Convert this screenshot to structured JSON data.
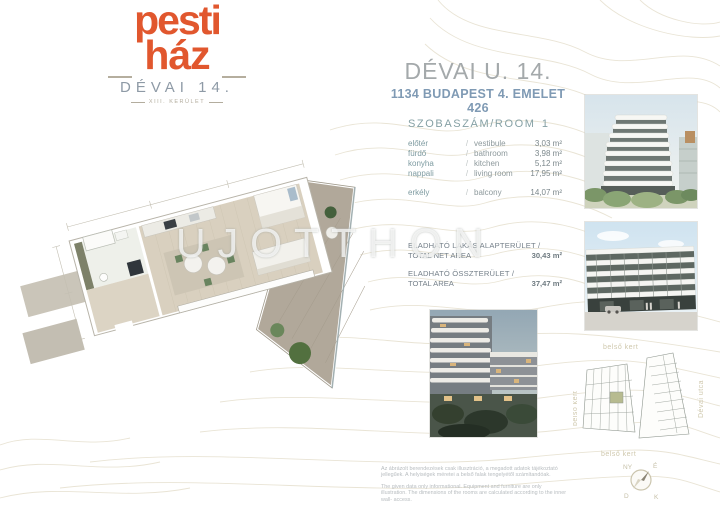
{
  "logo": {
    "word1": "pesti",
    "word2": "ház",
    "project": "DÉVAI 14.",
    "district": "XIII. KERÜLET",
    "brand_color": "#e1572e"
  },
  "header": {
    "title": "DÉVAI U. 14.",
    "subtitle": "1134 BUDAPEST 4. EMELET 426",
    "title_color": "#a4a9ab",
    "subtitle_color": "#7f9ab4"
  },
  "room_table": {
    "header": "SZOBASZÁM/ROOM",
    "room_count": "1",
    "sep": "/",
    "rows": [
      {
        "hu": "előtér",
        "en": "vestibule",
        "area": "3,03 m²"
      },
      {
        "hu": "fürdő",
        "en": "bathroom",
        "area": "3,98 m²"
      },
      {
        "hu": "konyha",
        "en": "kitchen",
        "area": "5,12 m²"
      },
      {
        "hu": "nappali",
        "en": "living room",
        "area": "17,95 m²"
      },
      {
        "hu": "erkély",
        "en": "balcony",
        "area": "14,07 m²"
      }
    ]
  },
  "totals": [
    {
      "label_hu": "ELADHATÓ LAKÁS ALAPTERÜLET /",
      "label_en": "TOTAL NET AREA",
      "value": "30,43 m²"
    },
    {
      "label_hu": "ELADHATÓ ÖSSZTERÜLET /",
      "label_en": "TOTAL AREA",
      "value": "37,47 m²"
    }
  ],
  "watermark": "UJOTTHON",
  "site_plan": {
    "garden_label": "belső kert",
    "street_label": "Dévai utca",
    "highlight_color": "#b7bb90"
  },
  "compass": {
    "nw": "NY",
    "ne": "É",
    "sw": "D",
    "se": "K"
  },
  "disclaimer": {
    "hu": "Az ábrázolt berendezések csak illusztráció, a megadott adatok tájékoztató jellegűek. A helyiségek méretei a belső falak tengelyétől számítandóak.",
    "en": "The given data only informational. Equipment and furniture are only illustration. The dimensions of the rooms are calculated according to the inner wall- access."
  }
}
